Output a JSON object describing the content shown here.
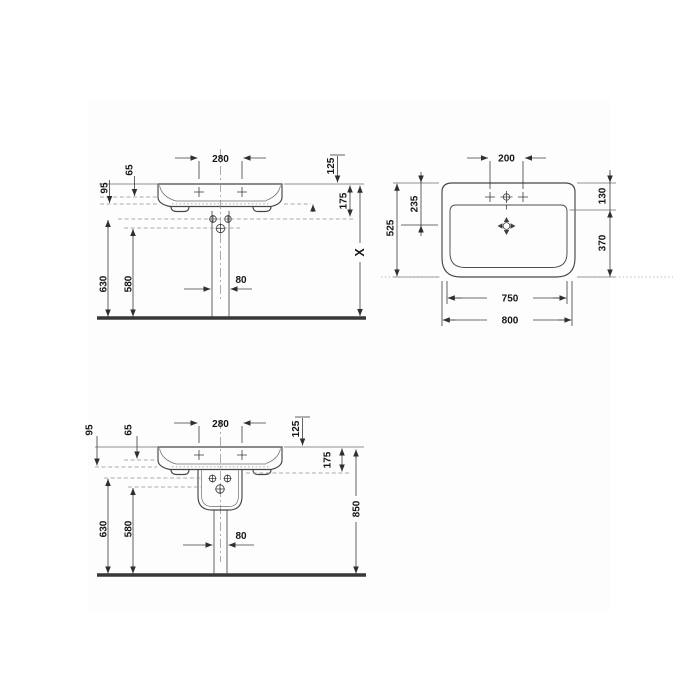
{
  "colors": {
    "ink": "#3f3f3f",
    "floor_line": "#383838",
    "background": "#ffffff",
    "reference_dash": "#8f8f8f"
  },
  "front_view_variable": {
    "d280": "280",
    "d125": "125",
    "d65": "65",
    "d95": "95",
    "d175": "175",
    "d630": "630",
    "d580": "580",
    "d80": "80",
    "dX": "X"
  },
  "plan_view": {
    "d200": "200",
    "d525": "525",
    "d235": "235",
    "d130": "130",
    "d370": "370",
    "d750": "750",
    "d800": "800"
  },
  "front_view_fixed": {
    "d280": "280",
    "d125": "125",
    "d65": "65",
    "d95": "95",
    "d175": "175",
    "d630": "630",
    "d580": "580",
    "d80": "80",
    "d850": "850"
  }
}
